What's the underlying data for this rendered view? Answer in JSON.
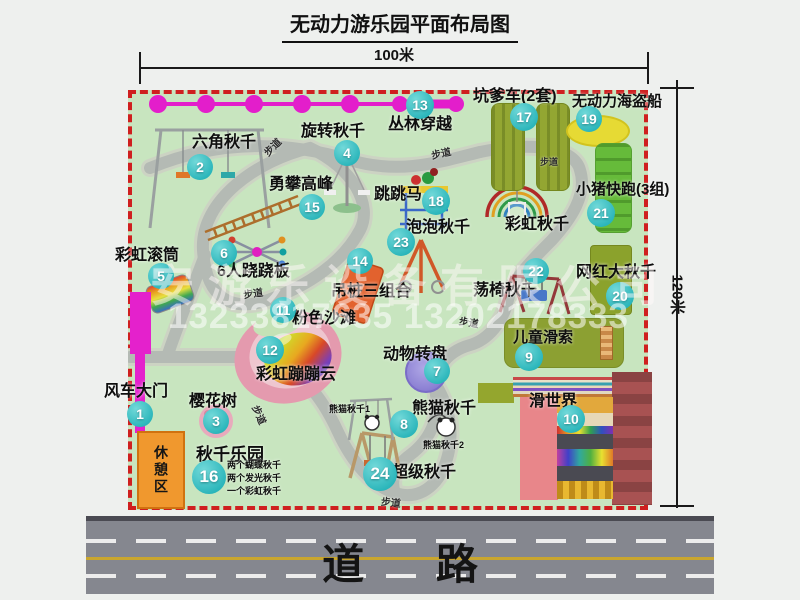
{
  "title": "无动力游乐园平面布局图",
  "dimensions": {
    "width": "100米",
    "height": "120米"
  },
  "road_label": "道 路",
  "watermark": {
    "company": "安游乐设备有限公司",
    "phone": "13233817635 13202178333"
  },
  "path_label": "步道",
  "rest_area_label": "休憩区",
  "rainbow_swing_label": "彩虹秋千",
  "panda_swing_sub1": "熊猫秋千1",
  "panda_swing_sub2": "熊猫秋千2",
  "swing_park_notes": {
    "n1": "两个蝴蝶秋千",
    "n2": "两个发光秋千",
    "n3": "一个彩虹秋千"
  },
  "attractions": [
    {
      "num": "1",
      "label": "风车大门"
    },
    {
      "num": "2",
      "label": "六角秋千"
    },
    {
      "num": "3",
      "label": "樱花树"
    },
    {
      "num": "4",
      "label": "旋转秋千"
    },
    {
      "num": "5",
      "label": "彩虹滚筒"
    },
    {
      "num": "6",
      "label": "6人跷跷板"
    },
    {
      "num": "7",
      "label": "动物转盘"
    },
    {
      "num": "8",
      "label": "熊猫秋千"
    },
    {
      "num": "9",
      "label": "儿童滑索"
    },
    {
      "num": "10",
      "label": "滑世界"
    },
    {
      "num": "11",
      "label": "粉色沙滩"
    },
    {
      "num": "12",
      "label": "彩虹蹦蹦云"
    },
    {
      "num": "13",
      "label": "丛林穿越"
    },
    {
      "num": "14",
      "label": "吊桩三组合"
    },
    {
      "num": "15",
      "label": "勇攀高峰"
    },
    {
      "num": "16",
      "label": "秋千乐园"
    },
    {
      "num": "17",
      "label": "坑爹车(2套)"
    },
    {
      "num": "18",
      "label": "跳跳马"
    },
    {
      "num": "19",
      "label": "无动力海盗船"
    },
    {
      "num": "20",
      "label": "网红大秋千"
    },
    {
      "num": "21",
      "label": "小猪快跑(3组)"
    },
    {
      "num": "22",
      "label": "荡椅秋千"
    },
    {
      "num": "23",
      "label": "泡泡秋千"
    },
    {
      "num": "24",
      "label": "超级秋千"
    }
  ],
  "colors": {
    "badge": "#2ab5ba",
    "map_border": "#cf1f1f",
    "park_green": "#c8e5bf",
    "gate_magenta": "#e421cc",
    "road_gray": "#85878f",
    "rest_orange": "#f0982e"
  }
}
